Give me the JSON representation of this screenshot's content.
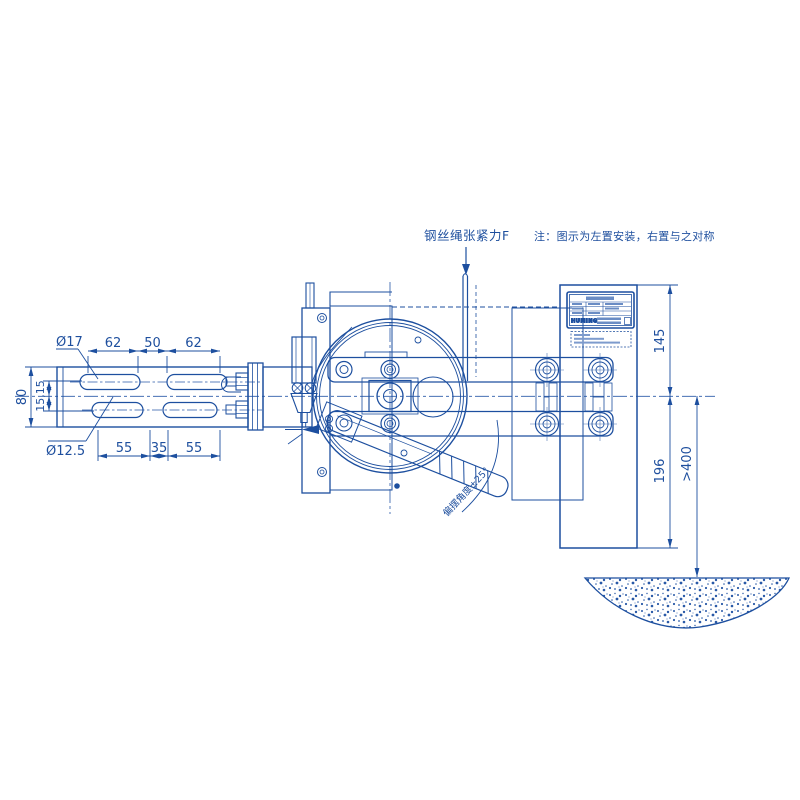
{
  "annotations": {
    "tension_force": "钢丝绳张紧力F",
    "install_note": "注：图示为左置安装，右置与之对称",
    "swing_angle": "偏摆角度±25°"
  },
  "dimensions": {
    "slot_pitch_top": [
      "62",
      "50",
      "62"
    ],
    "slot_pitch_bottom": [
      "55",
      "35",
      "55"
    ],
    "bracket_height": "80",
    "row_offsets": "15,15",
    "slot_width_top": "Ø17",
    "slot_width_bottom": "Ø12.5",
    "plate_upper": "145",
    "plate_lower": "196",
    "ground_clearance": ">400"
  },
  "nameplate": {
    "brand": "HUMING"
  },
  "colors": {
    "line": "#1d4f9f",
    "line_light": "#5578b5",
    "background": "#ffffff"
  }
}
